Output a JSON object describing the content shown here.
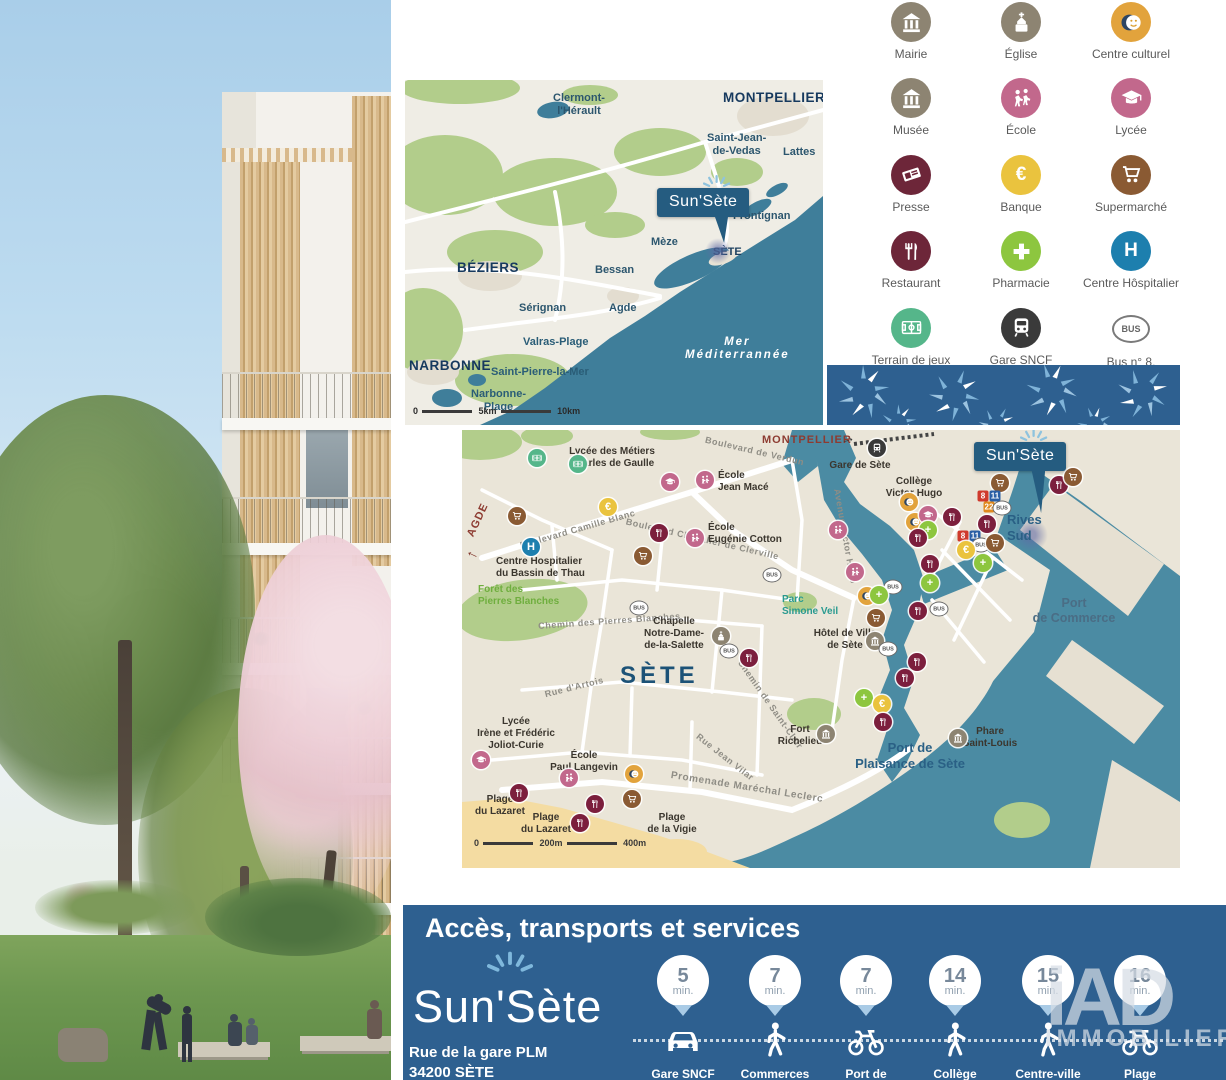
{
  "project": {
    "name": "Sun'Sète"
  },
  "colors": {
    "banner_blue": "#2e6090",
    "flag_blue": "#255c80",
    "region_sea": "#3f7e9a",
    "city_water": "#4b8ba3",
    "sand": "#f4dca2",
    "park_green": "#b2cd8b",
    "ray_blue": "#7fb8dc"
  },
  "legend": {
    "items": [
      {
        "label": "Mairie",
        "icon": "townhall-icon",
        "color": "#8d8472"
      },
      {
        "label": "Église",
        "icon": "church-icon",
        "color": "#8d8472"
      },
      {
        "label": "Centre culturel",
        "icon": "masks-icon",
        "color": "#e2a33c"
      },
      {
        "label": "Musée",
        "icon": "museum-icon",
        "color": "#8d8472"
      },
      {
        "label": "École",
        "icon": "children-icon",
        "color": "#c2688c"
      },
      {
        "label": "Lycée",
        "icon": "gradcap-icon",
        "color": "#c2688c"
      },
      {
        "label": "Presse",
        "icon": "newspaper-icon",
        "color": "#6d2639"
      },
      {
        "label": "Banque",
        "icon": "euro-icon",
        "color": "#eac33e"
      },
      {
        "label": "Supermarché",
        "icon": "cart-icon",
        "color": "#8a5a33"
      },
      {
        "label": "Restaurant",
        "icon": "cutlery-icon",
        "color": "#6d2639"
      },
      {
        "label": "Pharmacie",
        "icon": "cross-icon",
        "color": "#8dc63f"
      },
      {
        "label": "Centre Hôspitalier",
        "icon": "hospital-h-icon",
        "color": "#1d7fae"
      },
      {
        "label": "Terrain de jeux",
        "icon": "sportsfield-icon",
        "color": "#55b68a"
      },
      {
        "label": "Gare SNCF",
        "icon": "train-icon",
        "color": "#3a3a3a"
      },
      {
        "label": "Bus n° 8,\n11 et 22",
        "icon": "bus-oval-icon",
        "color": null
      }
    ]
  },
  "region_map": {
    "labels": [
      "Clermont-\nl'Hérault",
      "MONTPELLIER",
      "Saint-Jean-\nde-Vedas",
      "Lattes",
      "Frontignan",
      "Mèze",
      "SÈTE",
      "BÉZIERS",
      "Bessan",
      "Sérignan",
      "Agde",
      "Valras-Plage",
      "NARBONNE",
      "Saint-Pierre-la-Mer",
      "Narbonne-\nPlage",
      "Mer\nMéditerrannée"
    ],
    "scale": [
      "0",
      "5km",
      "10km"
    ]
  },
  "city_map": {
    "big_label": "SÈTE",
    "directions": [
      "MONTPELLIER",
      "AGDE"
    ],
    "pois": [
      "Lycée des Métiers\nCharles de Gaulle",
      "École\nJean Macé",
      "École\nEugénie Cotton",
      "Centre Hospitalier\ndu Bassin de Thau",
      "Forêt des\nPierres Blanches",
      "Parc\nSimone Veil",
      "Chapelle\nNotre-Dame-\nde-la-Salette",
      "Hôtel de Ville\nde Sète",
      "Collège\nVictor Hugo",
      "Gare de Sète",
      "Rives\nSud",
      "Port\nde Commerce",
      "Port de\nPlaisance de Sète",
      "Phare\nSaint-Louis",
      "Fort\nRichelieu",
      "Lycée\nIrène et Frédéric\nJoliot-Curie",
      "École\nPaul Langevin",
      "Plage\ndu Lazaret",
      "Plage\ndu Lazaret",
      "Plage\nde la Vigie"
    ],
    "streets": [
      "Boulevard Camille Blanc",
      "Boulevard Chevalier de Clerville",
      "Boulevard de Verdun",
      "Avenue Victor Hugo",
      "Chemin des Pierres Blanches",
      "Rue d'Artois",
      "Promenade Maréchal Leclerc",
      "Rue Jean Vilar",
      "Chemin de Saint-Clair"
    ],
    "scale": [
      "0",
      "200m",
      "400m"
    ],
    "marker_styles": {
      "terrain": {
        "color": "#55b68a",
        "icon": "field"
      },
      "lycee": {
        "color": "#c2688c",
        "icon": "gradcap"
      },
      "ecole": {
        "color": "#c2688c",
        "icon": "school"
      },
      "banque": {
        "color": "#eac33e",
        "text": "€"
      },
      "supermarche": {
        "color": "#8a5a33",
        "icon": "cart"
      },
      "restaurant": {
        "color": "#7c1f3d",
        "icon": "fork"
      },
      "hopital": {
        "color": "#1d7fae",
        "text": "H"
      },
      "chapelle": {
        "color": "#8d8472",
        "icon": "church"
      },
      "gare": {
        "color": "#3a3a3a",
        "icon": "train"
      },
      "culture": {
        "color": "#e2a33c",
        "icon": "masks"
      },
      "mairie": {
        "color": "#8d8472",
        "icon": "townhall"
      },
      "musee": {
        "color": "#8d8472",
        "icon": "townhall"
      },
      "pharmacie": {
        "color": "#8dc63f",
        "text": "+"
      },
      "bus8": {
        "badge": "#cf3a2c",
        "text": "8"
      },
      "bus11": {
        "badge": "#2a5fa5",
        "text": "11"
      },
      "bus22": {
        "badge": "#e0891e",
        "text": "22"
      },
      "bus": {
        "oval": true,
        "text": "BUS"
      }
    },
    "markers": [
      {
        "t": "terrain",
        "x": 75,
        "y": 28
      },
      {
        "t": "terrain",
        "x": 116,
        "y": 34
      },
      {
        "t": "lycee",
        "x": 208,
        "y": 52
      },
      {
        "t": "ecole",
        "x": 243,
        "y": 50
      },
      {
        "t": "banque",
        "x": 146,
        "y": 77
      },
      {
        "t": "supermarche",
        "x": 55,
        "y": 86
      },
      {
        "t": "restaurant",
        "x": 197,
        "y": 103
      },
      {
        "t": "ecole",
        "x": 233,
        "y": 108
      },
      {
        "t": "supermarche",
        "x": 181,
        "y": 126
      },
      {
        "t": "hopital",
        "x": 69,
        "y": 117
      },
      {
        "t": "bus",
        "x": 310,
        "y": 145
      },
      {
        "t": "bus",
        "x": 177,
        "y": 178
      },
      {
        "t": "chapelle",
        "x": 259,
        "y": 206
      },
      {
        "t": "bus",
        "x": 267,
        "y": 221
      },
      {
        "t": "restaurant",
        "x": 287,
        "y": 228
      },
      {
        "t": "gare",
        "x": 415,
        "y": 18
      },
      {
        "t": "ecole",
        "x": 376,
        "y": 100
      },
      {
        "t": "ecole",
        "x": 393,
        "y": 142
      },
      {
        "t": "culture",
        "x": 447,
        "y": 72
      },
      {
        "t": "culture",
        "x": 453,
        "y": 92
      },
      {
        "t": "lycee",
        "x": 466,
        "y": 85
      },
      {
        "t": "restaurant",
        "x": 490,
        "y": 87
      },
      {
        "t": "pharmacie",
        "x": 466,
        "y": 100
      },
      {
        "t": "restaurant",
        "x": 456,
        "y": 108
      },
      {
        "t": "supermarche",
        "x": 538,
        "y": 53
      },
      {
        "t": "restaurant",
        "x": 597,
        "y": 55
      },
      {
        "t": "supermarche",
        "x": 611,
        "y": 47
      },
      {
        "t": "bus8",
        "x": 521,
        "y": 66
      },
      {
        "t": "bus11",
        "x": 533,
        "y": 66
      },
      {
        "t": "bus22",
        "x": 527,
        "y": 77
      },
      {
        "t": "bus",
        "x": 540,
        "y": 78
      },
      {
        "t": "restaurant",
        "x": 525,
        "y": 94
      },
      {
        "t": "bus8",
        "x": 501,
        "y": 106
      },
      {
        "t": "bus11",
        "x": 513,
        "y": 106
      },
      {
        "t": "bus",
        "x": 519,
        "y": 115
      },
      {
        "t": "banque",
        "x": 504,
        "y": 120
      },
      {
        "t": "supermarche",
        "x": 533,
        "y": 113
      },
      {
        "t": "pharmacie",
        "x": 521,
        "y": 133
      },
      {
        "t": "restaurant",
        "x": 468,
        "y": 134
      },
      {
        "t": "pharmacie",
        "x": 468,
        "y": 153
      },
      {
        "t": "bus",
        "x": 431,
        "y": 157
      },
      {
        "t": "culture",
        "x": 405,
        "y": 166
      },
      {
        "t": "pharmacie",
        "x": 417,
        "y": 165
      },
      {
        "t": "supermarche",
        "x": 414,
        "y": 188
      },
      {
        "t": "mairie",
        "x": 413,
        "y": 211
      },
      {
        "t": "bus",
        "x": 426,
        "y": 219
      },
      {
        "t": "restaurant",
        "x": 456,
        "y": 181
      },
      {
        "t": "bus",
        "x": 477,
        "y": 179
      },
      {
        "t": "restaurant",
        "x": 455,
        "y": 232
      },
      {
        "t": "restaurant",
        "x": 443,
        "y": 248
      },
      {
        "t": "pharmacie",
        "x": 402,
        "y": 268
      },
      {
        "t": "banque",
        "x": 420,
        "y": 274
      },
      {
        "t": "restaurant",
        "x": 421,
        "y": 292
      },
      {
        "t": "musee",
        "x": 364,
        "y": 304
      },
      {
        "t": "musee",
        "x": 496,
        "y": 308
      },
      {
        "t": "lycee",
        "x": 19,
        "y": 330
      },
      {
        "t": "ecole",
        "x": 107,
        "y": 348
      },
      {
        "t": "culture",
        "x": 172,
        "y": 344
      },
      {
        "t": "supermarche",
        "x": 170,
        "y": 369
      },
      {
        "t": "restaurant",
        "x": 57,
        "y": 363
      },
      {
        "t": "restaurant",
        "x": 118,
        "y": 393
      },
      {
        "t": "restaurant",
        "x": 133,
        "y": 374
      }
    ]
  },
  "banner": {
    "title": "Accès, transports et services",
    "address": "Rue de la gare PLM\n34200 SÈTE",
    "items": [
      {
        "time": "5",
        "unit": "min.",
        "mode": "car-icon",
        "label": "Gare SNCF\nde Sète"
      },
      {
        "time": "7",
        "unit": "min.",
        "mode": "walk-icon",
        "label": "Commerces"
      },
      {
        "time": "7",
        "unit": "min.",
        "mode": "bike-icon",
        "label": "Port de Plaisance\nde Sète"
      },
      {
        "time": "14",
        "unit": "min.",
        "mode": "walk-icon",
        "label": "Collège\nVictor Hugo"
      },
      {
        "time": "15",
        "unit": "min.",
        "mode": "walk-icon",
        "label": "Centre-ville\n(mairie)"
      },
      {
        "time": "16",
        "unit": "min.",
        "mode": "bike-icon",
        "label": "Plage\nde Lazaret"
      }
    ],
    "watermark": {
      "big": "iAD",
      "small": "IMMOBILIER"
    }
  }
}
